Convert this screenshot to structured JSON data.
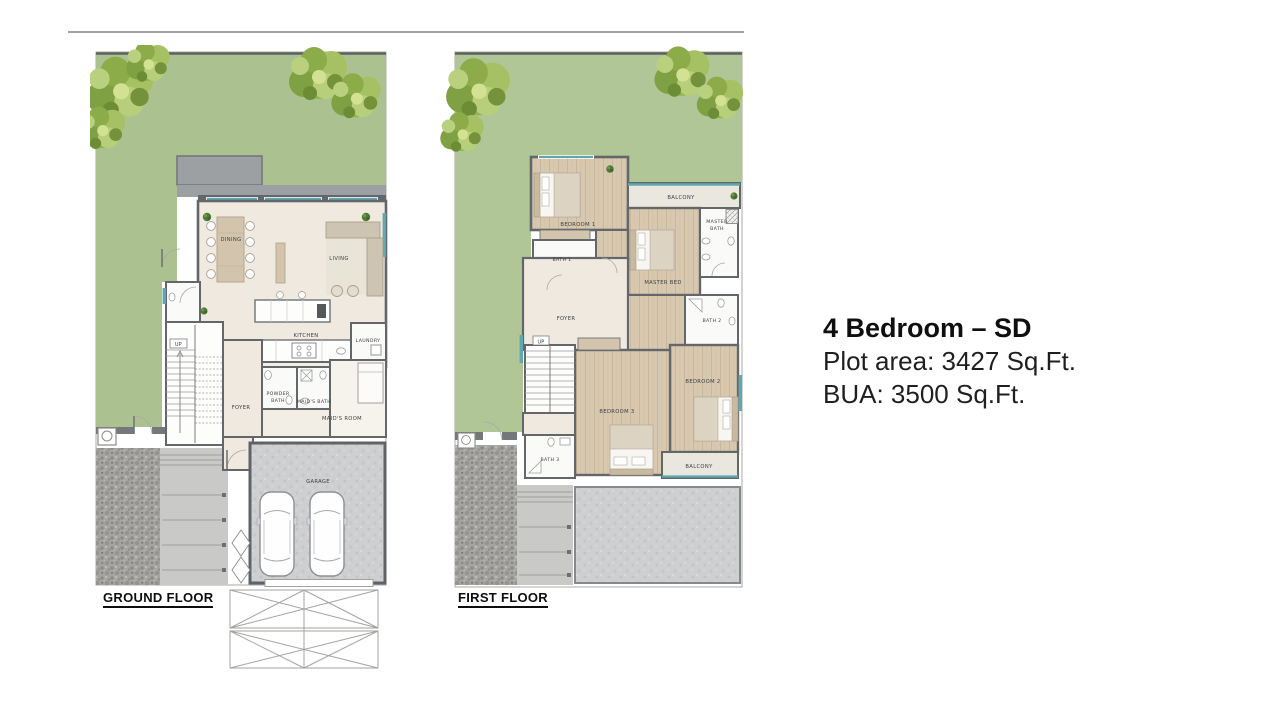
{
  "info": {
    "title": "4 Bedroom – SD",
    "plot_area": "Plot area: 3427 Sq.Ft.",
    "bua": "BUA: 3500 Sq.Ft."
  },
  "plans": {
    "ground": {
      "label": "GROUND FLOOR",
      "rooms": {
        "dining": "DINING",
        "living": "LIVING",
        "kitchen": "KITCHEN",
        "laundry": "LAUNDRY",
        "powder1": "POWDER",
        "powder2": "BATH",
        "maids_bath": "MAID'S BATH",
        "maids_room": "MAID'S ROOM",
        "foyer": "FOYER",
        "up": "UP",
        "garage": "GARAGE"
      }
    },
    "first": {
      "label": "FIRST FLOOR",
      "rooms": {
        "bedroom1": "BEDROOM 1",
        "bath1": "BATH 1",
        "balcony_top": "BALCONY",
        "master1": "MASTER",
        "master2": "BATH",
        "master_bed": "MASTER BED",
        "foyer": "FOYER",
        "up": "UP",
        "bath2": "BATH 2",
        "bedroom2": "BEDROOM 2",
        "bedroom3": "BEDROOM 3",
        "bath3": "BATH 3",
        "balcony_bottom": "BALCONY"
      }
    }
  },
  "colors": {
    "garden": "#abc290",
    "wall": "#63676a",
    "terrace": "#9da0a3",
    "floor_cream": "#efe9df",
    "floor_wood": "#d8c8b0",
    "floor_white": "#fbfbf9",
    "garage_floor": "#cdcfd1",
    "stone": "#a5a4a0",
    "walkway": "#c9c9c7",
    "balcony_floor": "#eae7de",
    "window_teal": "#5fa8b2",
    "tree_green": "#8fac3f",
    "text_dark": "#0f0f0f"
  }
}
